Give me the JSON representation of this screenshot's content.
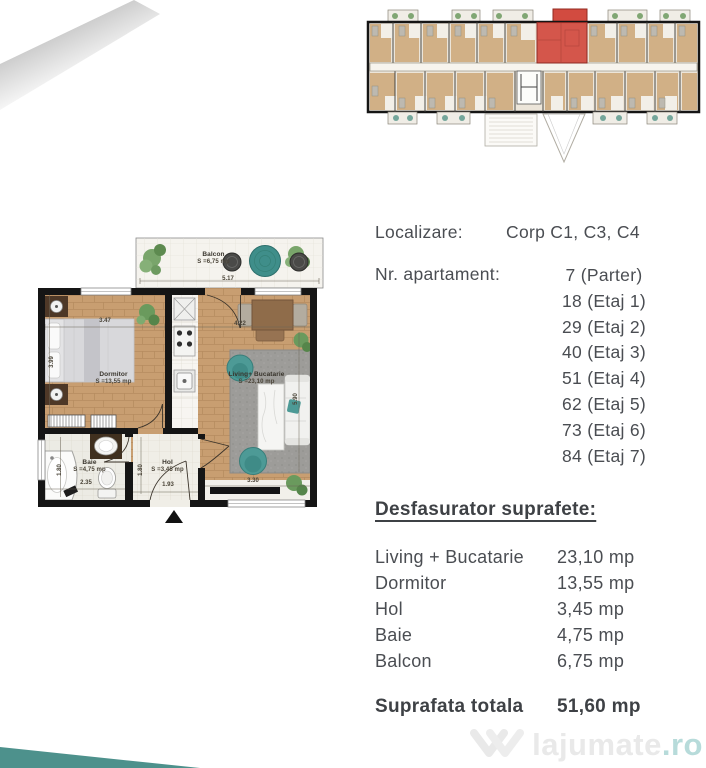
{
  "colors": {
    "accent_teal": "#4d918c",
    "highlight_red": "#d24b40",
    "text": "#4a4d52",
    "wood_floor": "#c89e71"
  },
  "location": {
    "label": "Localizare:",
    "value": "Corp C1, C3, C4"
  },
  "apartment_numbers": {
    "label": "Nr. apartament:",
    "entries": [
      "7 (Parter)",
      "18 (Etaj 1)",
      "29 (Etaj 2)",
      "40 (Etaj 3)",
      "51 (Etaj 4)",
      "62 (Etaj 5)",
      "73 (Etaj 6)",
      "84 (Etaj 7)"
    ]
  },
  "areas": {
    "heading": "Desfasurator suprafete:",
    "rows": [
      {
        "label": "Living + Bucatarie",
        "value": "23,10 mp"
      },
      {
        "label": "Dormitor",
        "value": "13,55 mp"
      },
      {
        "label": "Hol",
        "value": "3,45 mp"
      },
      {
        "label": "Baie",
        "value": "4,75 mp"
      },
      {
        "label": "Balcon",
        "value": "6,75 mp"
      }
    ],
    "total": {
      "label": "Suprafata totala",
      "value": "51,60 mp"
    }
  },
  "floor_plan": {
    "rooms": {
      "balcon": {
        "name": "Balcon",
        "area": "S =6,75 mp"
      },
      "dormitor": {
        "name": "Dormitor",
        "area": "S =13,55 mp"
      },
      "living": {
        "name": "Living+ Bucatarie",
        "area": "S =23,10 mp"
      },
      "baie": {
        "name": "Baie",
        "area": "S =4,75 mp"
      },
      "hol": {
        "name": "Hol",
        "area": "S =3,45 mp"
      }
    },
    "dimensions": {
      "balcon_width": "5.17",
      "dormitor_width": "3.47",
      "dormitor_depth": "3.99",
      "living_width": "4.22",
      "living_depth": "5.90",
      "living_bottom_width": "3.30",
      "baie_depth": "1.80",
      "baie_width": "2.35",
      "hol_depth": "1.80",
      "hol_width": "1.93"
    }
  },
  "watermark": {
    "brand": "lajumate",
    "tld": ".ro"
  }
}
